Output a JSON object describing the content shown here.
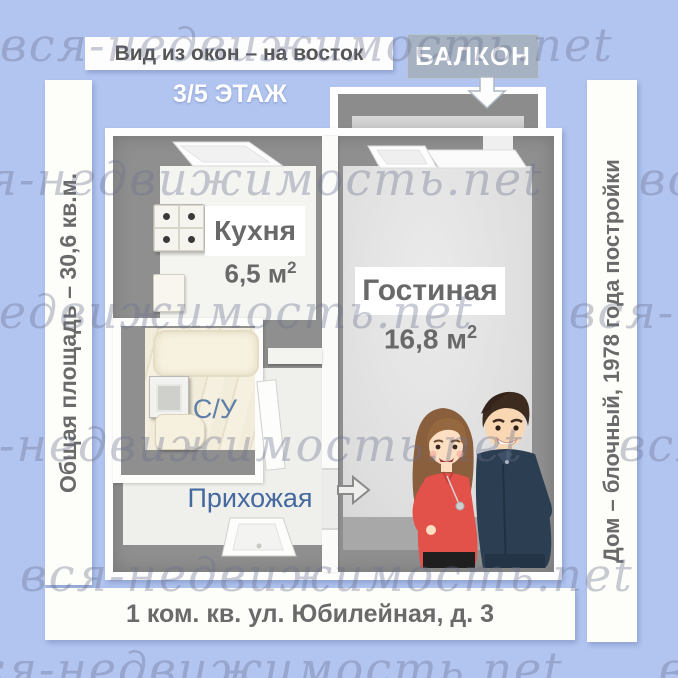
{
  "watermark": {
    "text": "вся-недвижимость.net"
  },
  "annotations": {
    "view_direction": "Вид из окон – на восток",
    "balcony": "БАЛКОН",
    "floor": "3/5 ЭТАЖ",
    "total_area": "Общая площадь – 30,6 кв.м.",
    "building": "Дом – блочный, 1978 года постройки",
    "address": "1 ком. кв. ул. Юбилейная, д. 3"
  },
  "rooms": {
    "kitchen": {
      "name": "Кухня",
      "area": "6,5 м",
      "area_sup": "2"
    },
    "living_room": {
      "name": "Гостиная",
      "area": "16,8 м",
      "area_sup": "2"
    },
    "bathroom": {
      "name": "С/У"
    },
    "hallway": {
      "name": "Прихожая"
    }
  },
  "colors": {
    "background": "#b2c5f1",
    "wall_gray": "#8f8f8f",
    "kitchen_floor": "#f4f4f1",
    "living_floor": "#e2e2e2",
    "bath_marble": "#f0e9d8",
    "room_label_gray": "#696969",
    "room_label_blue": "#44699f",
    "balcony_box": "#a6b2c2",
    "woman_top_red": "#e2514a",
    "man_shirt_navy": "#2c3e52"
  }
}
